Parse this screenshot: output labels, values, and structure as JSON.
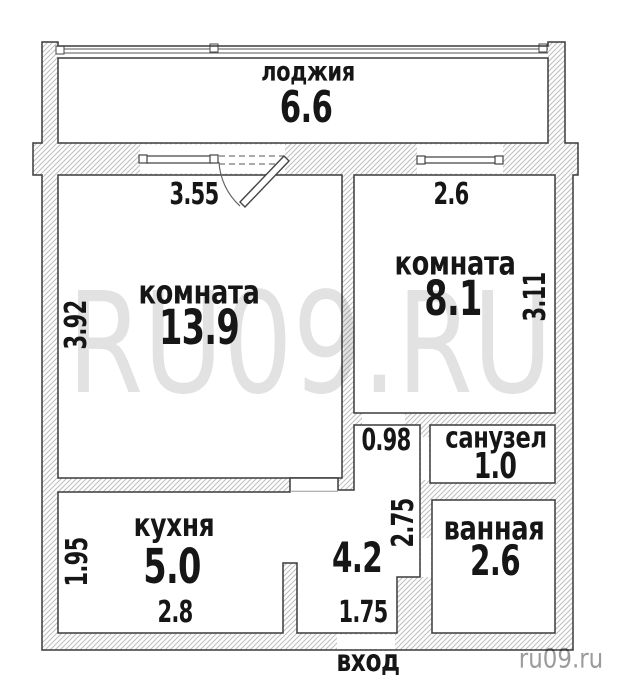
{
  "floorplan": {
    "rooms": [
      {
        "name": "лоджия",
        "area": "6.6"
      },
      {
        "name": "комната",
        "area": "13.9"
      },
      {
        "name": "комната",
        "area": "8.1"
      },
      {
        "name": "санузел",
        "area": "1.0"
      },
      {
        "name": "ванная",
        "area": "2.6"
      },
      {
        "name": "кухня",
        "area": "5.0"
      }
    ],
    "hall_area": "4.2",
    "entrance_label": "вход",
    "dimensions": {
      "room1_width": "3.55",
      "room1_depth": "3.92",
      "room2_width": "2.6",
      "room2_depth": "3.11",
      "hall_opening": "0.98",
      "hall_length": "2.75",
      "kitchen_depth": "1.95",
      "kitchen_width": "2.8",
      "entrance_width": "1.75"
    },
    "watermark_large": "RU09.RU",
    "watermark_small": "ru09.ru",
    "colors": {
      "wall_outline": "#3a3a3a",
      "wall_hatch": "#bdbdbd",
      "label_text": "#161616",
      "watermark_large": "#e2e2e2",
      "watermark_small": "#9b9b9b"
    }
  }
}
